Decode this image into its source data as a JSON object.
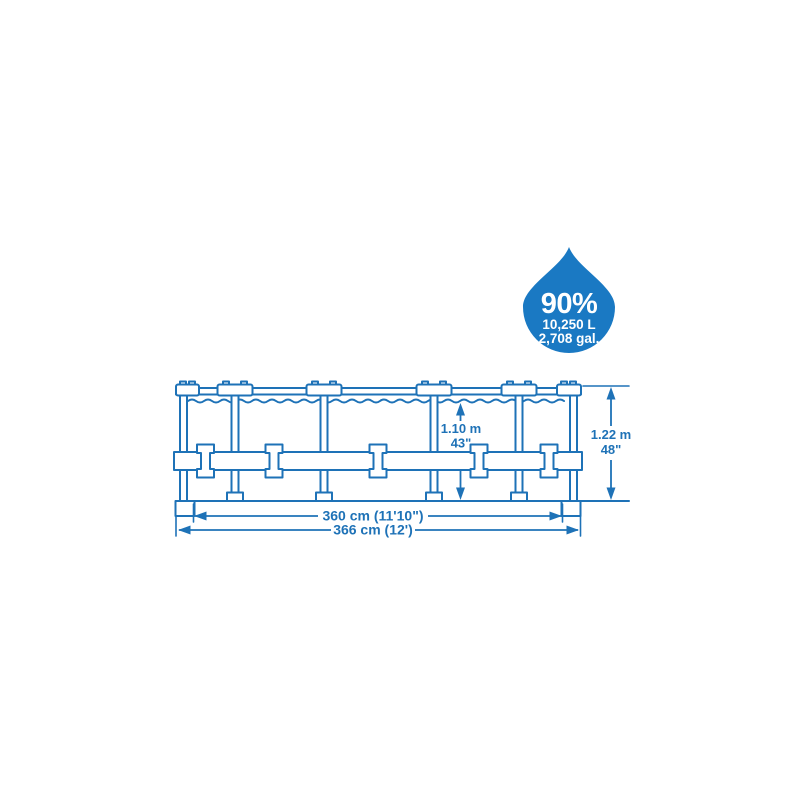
{
  "figure": {
    "background_color": "#ffffff",
    "capacity_badge": {
      "icon": "water-drop",
      "fill_percent": "90%",
      "capacity_liters": "10,250 L",
      "capacity_gallons": "2,708 gal.",
      "drop_color": "#1a79c3",
      "text_color": "#ffffff"
    },
    "pool_diagram": {
      "line_color": "#1e72b7",
      "water_height_metric": "1.10 m",
      "water_height_imperial": "43\"",
      "frame_height_metric": "1.22 m",
      "frame_height_imperial": "48\"",
      "water_diameter_label": "360 cm (11'10\")",
      "frame_diameter_label": "366 cm (12')"
    }
  }
}
